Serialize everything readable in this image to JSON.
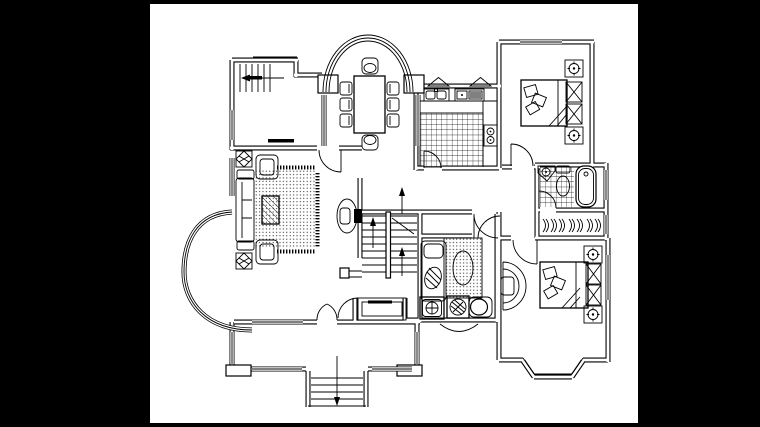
{
  "document": {
    "type": "architectural-floor-plan",
    "style": "black-and-white CAD line drawing",
    "storey": "residential floor plan with central staircase and front terrace"
  },
  "palette": {
    "surround": "#000000",
    "paper": "#ffffff",
    "line": "#000000"
  },
  "canvas": {
    "width": 760,
    "height": 427,
    "paper_left": 150,
    "paper_top": 4,
    "paper_width": 488,
    "paper_height": 419
  },
  "rooms": [
    {
      "id": "utility-room",
      "label": "top-left room with exterior side stair",
      "furniture": [
        "exterior-stair",
        "side-window",
        "sliding-door"
      ]
    },
    {
      "id": "dining-room",
      "label": "dining room inside semicircular arched bay window",
      "furniture": [
        "rectangular-dining-table",
        "eight-chairs"
      ]
    },
    {
      "id": "kitchen",
      "label": "kitchen with checkered tile floor",
      "furniture": [
        "double-sink",
        "cooktop-counter",
        "two-burner-stove",
        "entry-door"
      ]
    },
    {
      "id": "bedroom-northeast",
      "label": "top-right bedroom",
      "furniture": [
        "double-bed",
        "two-lamp-nightstands",
        "two-x-cabinets",
        "top-window"
      ]
    },
    {
      "id": "bathroom",
      "label": "bathroom with tiled floor",
      "furniture": [
        "corner-sink",
        "toilet",
        "bathtub"
      ]
    },
    {
      "id": "wardrobe-closet",
      "label": "closet with clothes-hanger row"
    },
    {
      "id": "bedroom-southeast",
      "label": "bottom-right bedroom with trapezoid bay window",
      "furniture": [
        "double-bed",
        "two-lamp-nightstands",
        "arc-dresser",
        "two-x-cabinets"
      ]
    },
    {
      "id": "living-room",
      "label": "living room with curved west bay window",
      "furniture": [
        "three-seat-sofa",
        "two-armchairs",
        "two-plant-stands",
        "dotted-rug",
        "hatched-coffee-table",
        "tv-on-tv-wall"
      ]
    },
    {
      "id": "study-room",
      "label": "small center-south room",
      "furniture": [
        "daybed",
        "dotted-rug-with-oval",
        "washing-machine",
        "plant-basket",
        "stool"
      ]
    },
    {
      "id": "stair-hall",
      "label": "central U-shaped staircase with direction arrows"
    },
    {
      "id": "entry-vestibule",
      "label": "entry vestibule with shoe cabinet and double entry door"
    },
    {
      "id": "terrace",
      "label": "front terrace with corner posts and exterior steps"
    }
  ],
  "symbols": {
    "arrow": "travel-direction arrow with solid black head",
    "window": "triple parallel line in wall opening",
    "door": "quarter-circle swing arc",
    "hanger": "double arc clothes hanger glyph",
    "tile": "square grid hatch",
    "rug": "dot-matrix fill with fringe ticks"
  }
}
